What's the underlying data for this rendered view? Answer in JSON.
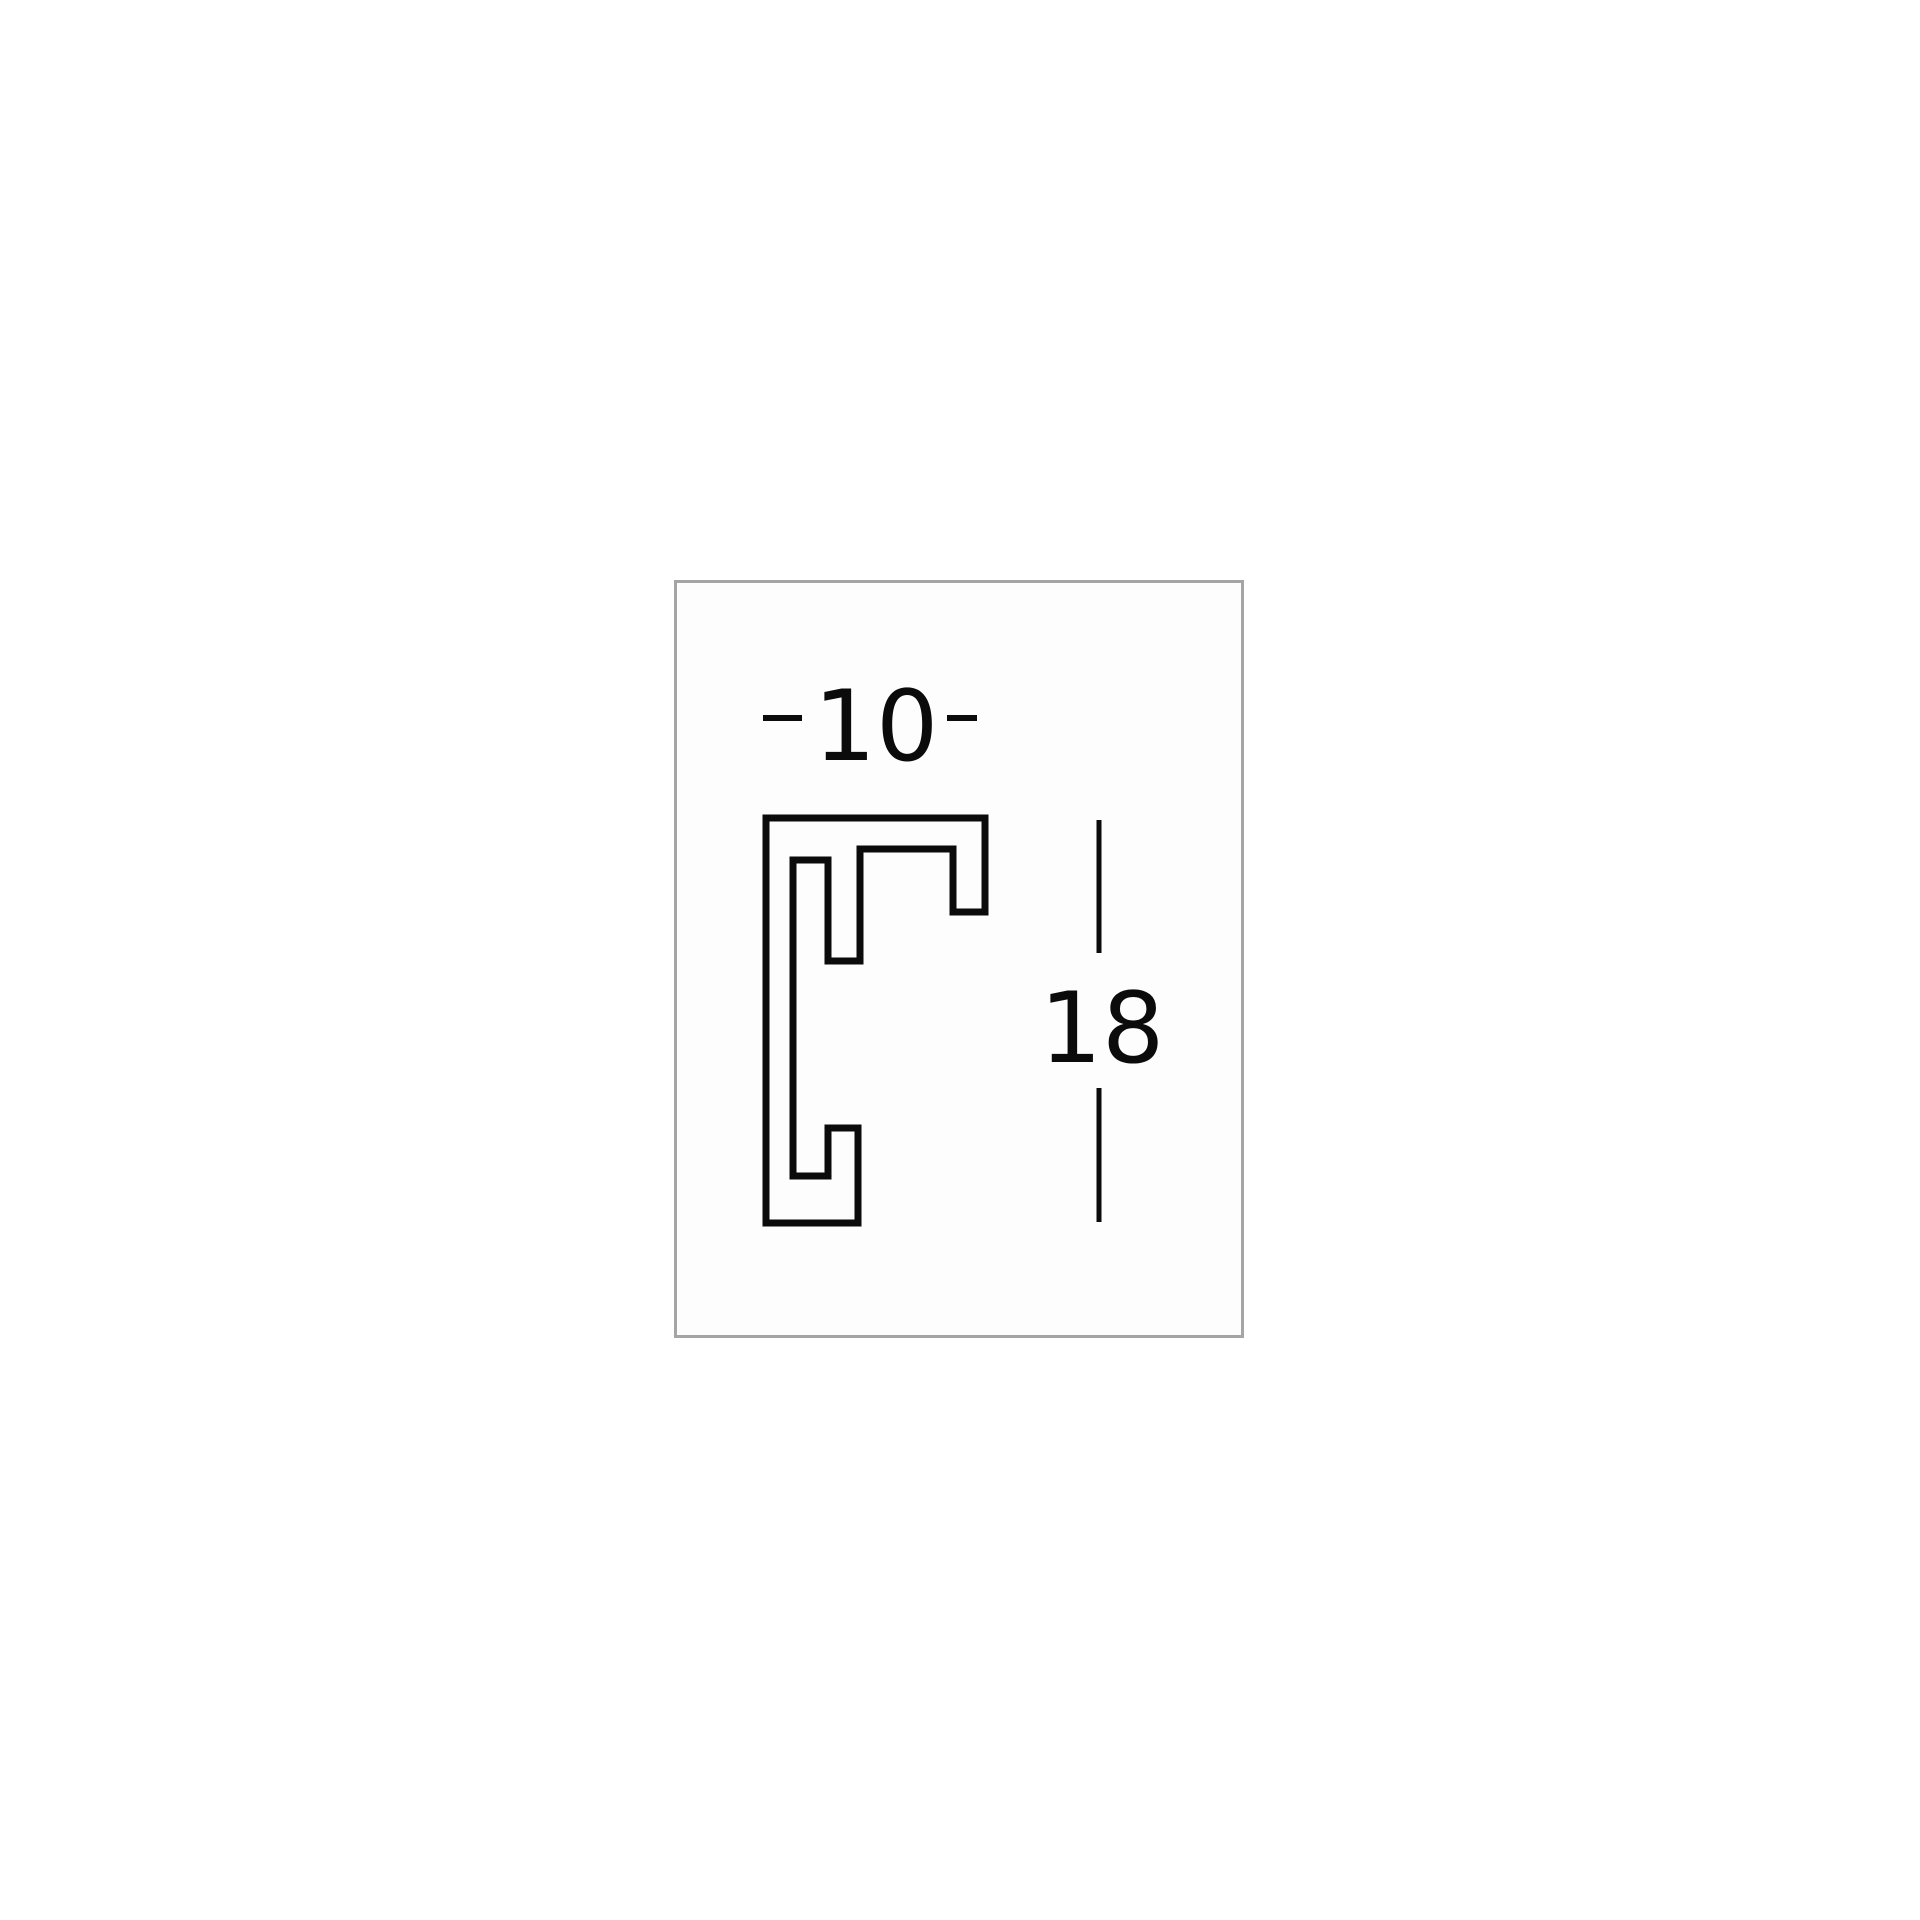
{
  "page": {
    "background": "#ffffff"
  },
  "panel": {
    "border_color": "#a5a5a5",
    "background": "#fdfdfd"
  },
  "profile": {
    "description": "picture-frame moulding cross-section outline",
    "line_color": "#0b0b0b"
  },
  "dimensions": {
    "width_label": "10",
    "height_label": "18",
    "label_color": "#0b0b0b"
  }
}
